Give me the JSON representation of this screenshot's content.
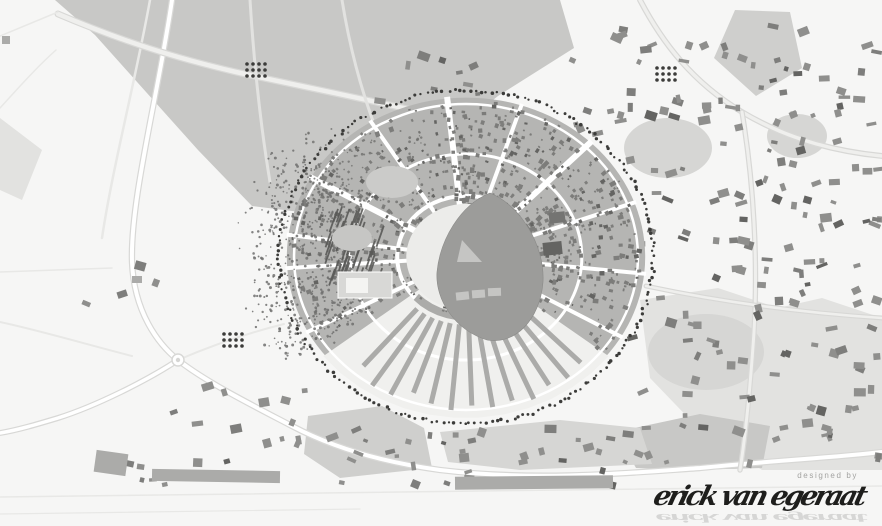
{
  "window": {
    "width": 882,
    "height": 526
  },
  "map": {
    "kind": "urban masterplan figure-ground map, grayscale",
    "credit_label": "designed by",
    "signature": "erick van egeraat",
    "palette": {
      "bg": "#f6f6f5",
      "field": "#d6d6d4",
      "field_light": "#e2e2e0",
      "forest": "#c8c8c6",
      "patch_mid": "#cfcfcd",
      "block": "#b5b5b3",
      "block_light": "#f0f0ee",
      "finger": "#ababa9",
      "building": "#8f8f8d",
      "building_mid": "#7e7e7c",
      "building_dark": "#646462",
      "speckle": "#7c7c7a",
      "stipple": "#6f6f6d",
      "hatch": "#5a5a58",
      "tree": "#3c3c3a",
      "park": "#9c9c9a",
      "park_light": "#c5c5c3",
      "inner_ring": "#ececea",
      "road": "#ffffff",
      "road_light": "#efefed",
      "road_casing": "#d8d8d6",
      "faint": "#e8e8e6",
      "ink": "#1e1e1c",
      "credit": "#a3a3a1"
    },
    "features": {
      "circular_city": "circular new town with radial and ring streets",
      "central_park": "teardrop-shaped central park with light clearings",
      "tree_ring": "dotted tree ring around the circular town",
      "west_forest": "stippled forest band with dark hatched tree rows, west side",
      "south_housing": "thin radial housing fingers, south sector",
      "surroundings": "existing town building scatter, fields and roads"
    }
  }
}
